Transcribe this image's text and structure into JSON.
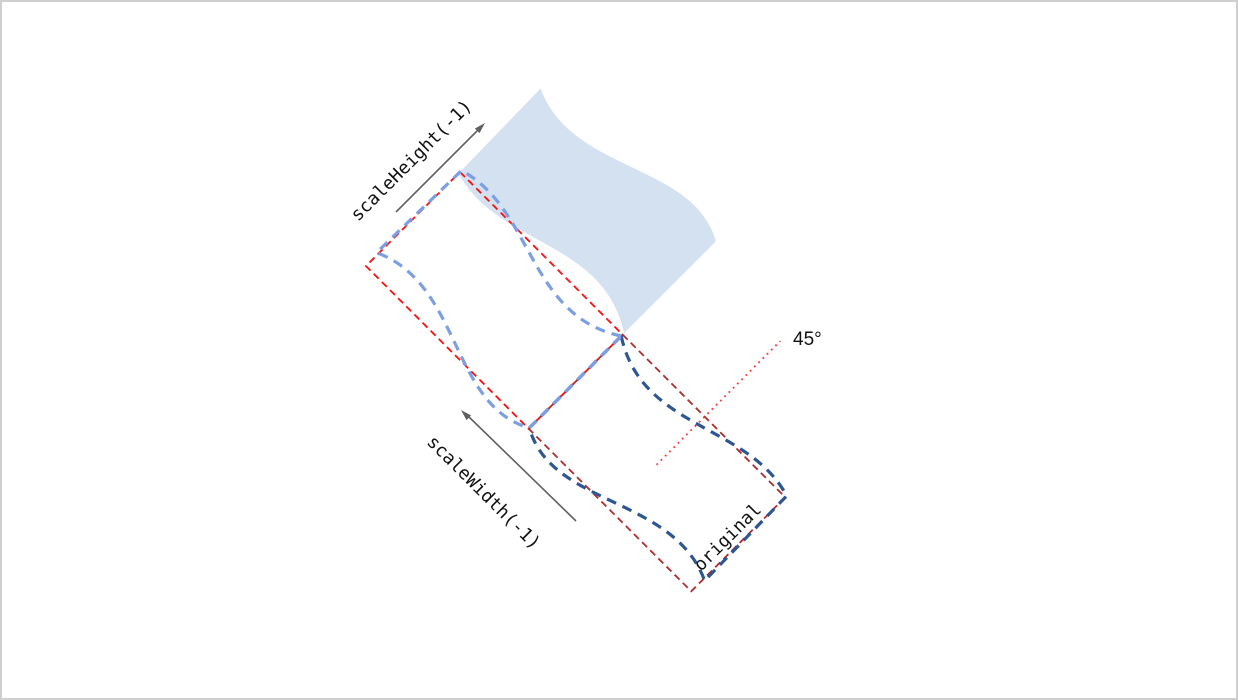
{
  "diagram": {
    "labels": {
      "scale_height": "scaleHeight(-1)",
      "scale_width": "scaleWidth(-1)",
      "original": "original",
      "angle": "45°"
    },
    "colors": {
      "shape_fill": "#D4E1F1",
      "width_flipped_outline": "#7C9FE3",
      "original_outline": "#2E5693",
      "flipped_bounds_box": "#FB0D0D",
      "original_bounds_box": "#B22A2A",
      "angle_line": "#FF3333",
      "arrow": "#606060",
      "text": "#111111"
    }
  }
}
